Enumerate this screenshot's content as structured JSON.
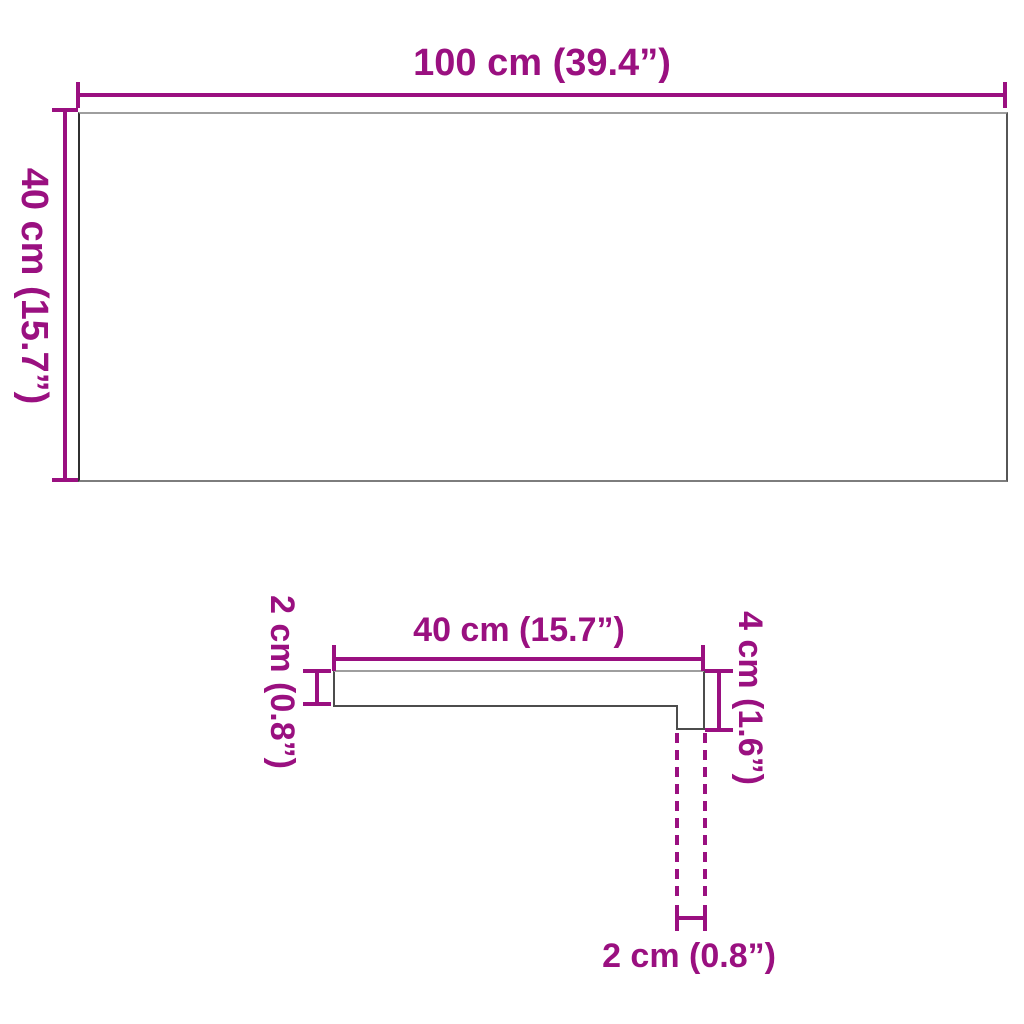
{
  "colors": {
    "accent": "#9A1080",
    "outline_light": "#9e9e9e",
    "outline_dark": "#4c4c4c"
  },
  "top_view": {
    "width_label": "100 cm (39.4”)",
    "height_label": "40 cm (15.7”)"
  },
  "side_view": {
    "depth_label": "40 cm (15.7”)",
    "thickness_label": "2 cm (0.8”)",
    "front_height_label": "4 cm (1.6”)",
    "lip_depth_label": "2 cm (0.8”)"
  }
}
